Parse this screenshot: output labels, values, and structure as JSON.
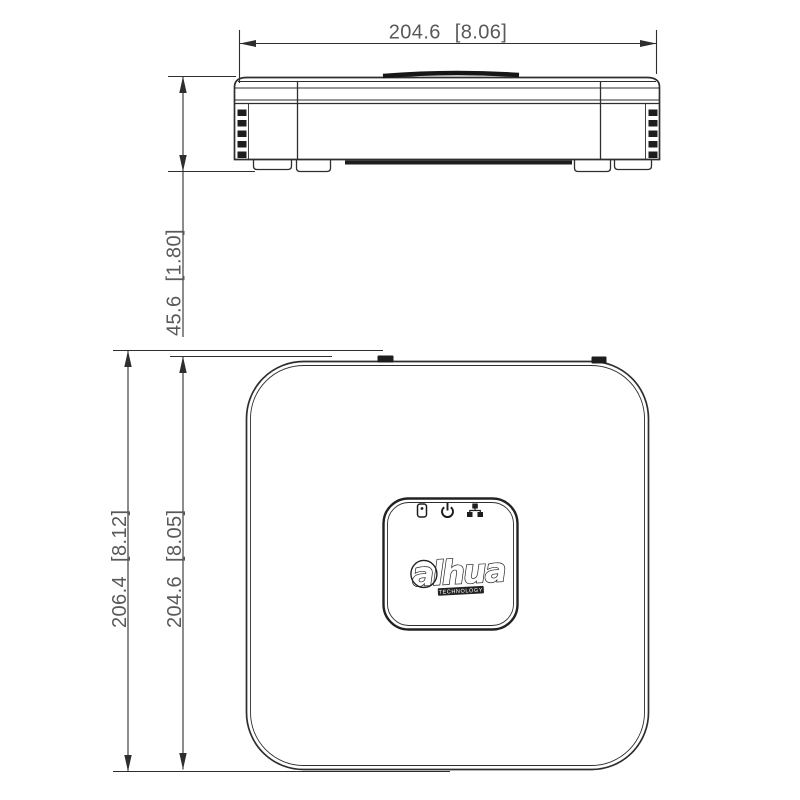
{
  "dimensions": {
    "front_width": "204.6 [8.06]",
    "front_height": "45.6 [1.80]",
    "top_overall": "206.4 [8.12]",
    "top_body": "204.6 [8.05]"
  },
  "logo": {
    "text": "alhua",
    "subtext": "TECHNOLOGY"
  },
  "indicators": [
    {
      "name": "hdd"
    },
    {
      "name": "power"
    },
    {
      "name": "network"
    }
  ],
  "colors": {
    "line": "#2e2e2e",
    "dim_text": "#595959",
    "dark_fill": "#1d1d1d",
    "background": "#ffffff"
  }
}
